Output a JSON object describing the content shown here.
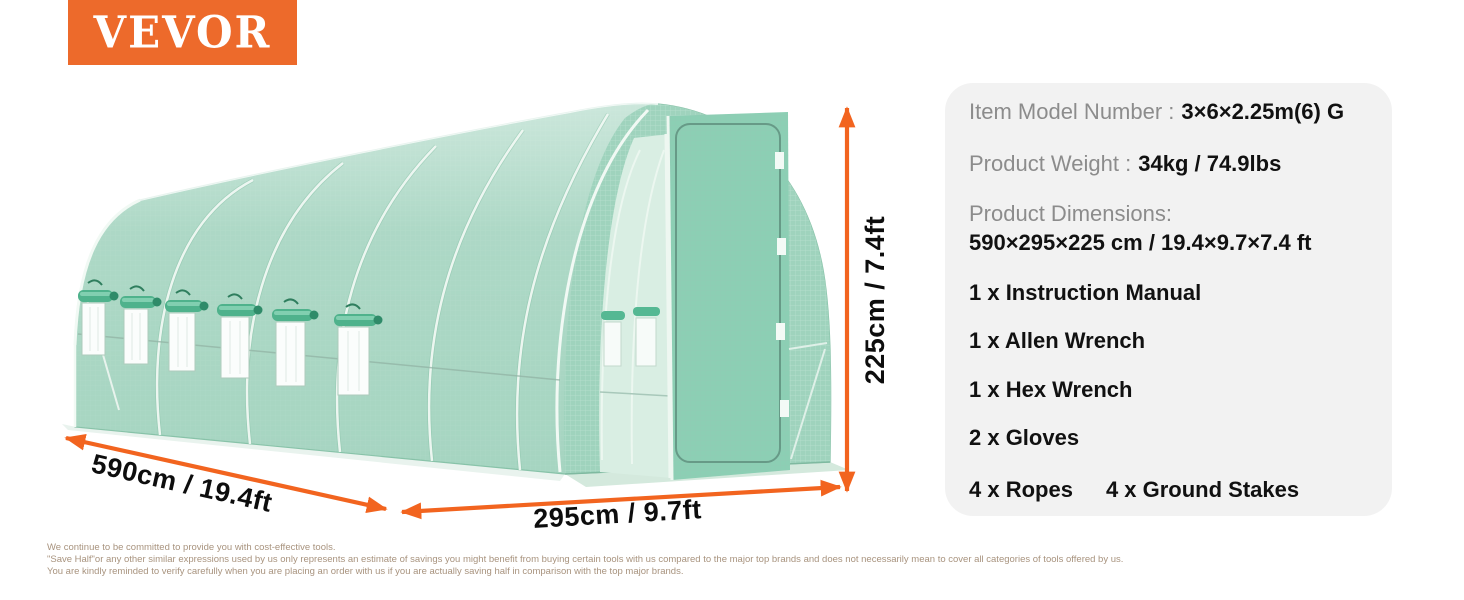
{
  "brand": {
    "logo_text": "VEVOR",
    "logo_bg_color": "#ED6A2B"
  },
  "illustration": {
    "description": "green walk-in tunnel greenhouse with six roll-up side windows and open front door",
    "arrow_color": "#F2641F",
    "greenhouse_green": "#A6D5C1",
    "dimensions": {
      "depth": "590cm / 19.4ft",
      "width": "295cm / 9.7ft",
      "height": "225cm / 7.4ft"
    }
  },
  "spec_panel": {
    "bg_color": "#F2F2F2",
    "model": {
      "label": "Item Model Number :",
      "value": "3×6×2.25m(6) G"
    },
    "weight": {
      "label": "Product Weight :",
      "value": "34kg / 74.9lbs"
    },
    "dimensions": {
      "label": "Product Dimensions:",
      "value": "590×295×225 cm / 19.4×9.7×7.4 ft"
    },
    "included_items": [
      "1 x Instruction Manual",
      "1 x Allen Wrench",
      "1 x Hex Wrench",
      "2 x Gloves"
    ],
    "included_items_last_row": [
      "4 x Ropes",
      "4 x Ground Stakes"
    ]
  },
  "disclaimer": {
    "text_color": "#A8937E",
    "lines": [
      "We continue to be committed to provide you with cost-effective tools.",
      "\"Save Half\"or any other similar expressions used by us only represents an estimate of savings you might benefit from buying certain tools with us compared to the major top brands and does not necessarily mean to cover all categories of tools offered by us.",
      "You are kindly reminded to verify carefully when you are placing an order with us if you are actually saving half in comparison with the top major brands."
    ]
  }
}
